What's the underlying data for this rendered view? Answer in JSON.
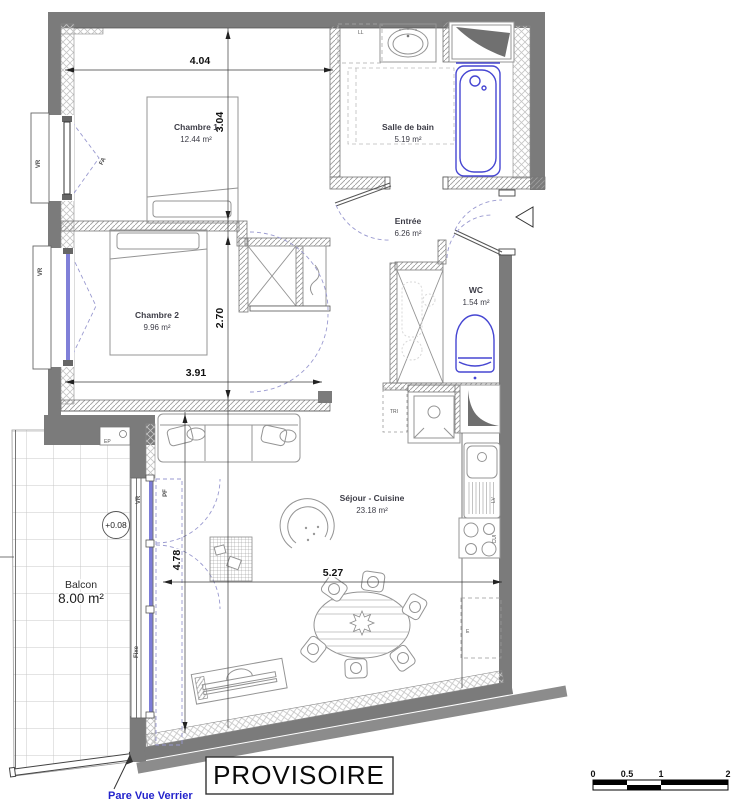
{
  "plan": {
    "stamp": "PROVISOIRE",
    "annotation": {
      "pare_vue": "Pare Vue Verrier",
      "level": "+0.08"
    },
    "rooms": {
      "chambre1": {
        "name": "Chambre 1",
        "area": "12.44 m²"
      },
      "salle_de_bain": {
        "name": "Salle de bain",
        "area": "5.19 m²"
      },
      "entree": {
        "name": "Entrée",
        "area": "6.26 m²"
      },
      "wc": {
        "name": "WC",
        "area": "1.54 m²"
      },
      "chambre2": {
        "name": "Chambre 2",
        "area": "9.96 m²"
      },
      "sejour": {
        "name": "Séjour - Cuisine",
        "area": "23.18 m²"
      },
      "balcon": {
        "name": "Balcon",
        "area": "8.00 m²"
      }
    },
    "dimensions": {
      "d404": "4.04",
      "d304": "3.04",
      "d270": "2.70",
      "d391": "3.91",
      "d527": "5.27",
      "d478": "4.78"
    },
    "openings": {
      "vr": "VR",
      "fa": "FA",
      "pf": "PF",
      "fixe": "Fixe"
    },
    "equipment": {
      "ll": "LL",
      "lv": "LV",
      "cui": "CUI",
      "tri": "TRI",
      "e": "E",
      "ep": "EP"
    },
    "scale_bar": {
      "t0": "0",
      "t05": "0.5",
      "t1": "1",
      "t2": "2"
    },
    "colors": {
      "wall": "#7b7b7b",
      "fixture_blue": "#4646d2",
      "door_swing": "#9a9ad0",
      "annotation_blue": "#2323cc"
    }
  }
}
